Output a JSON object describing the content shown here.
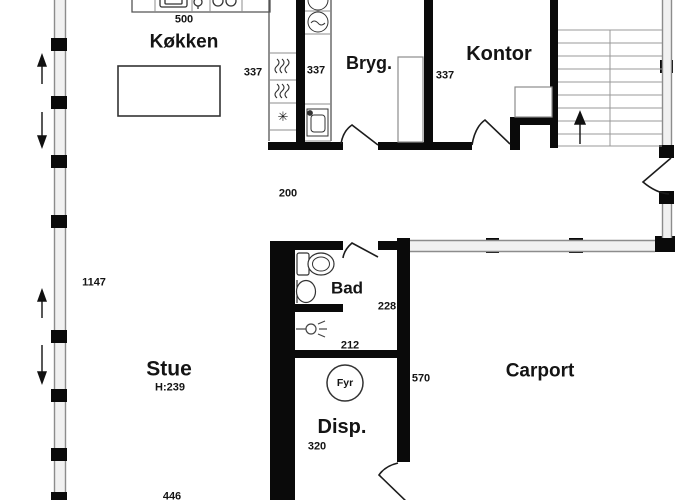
{
  "rooms": {
    "kokken": {
      "label": "Køkken"
    },
    "bryg": {
      "label": "Bryg."
    },
    "kontor": {
      "label": "Kontor"
    },
    "bad": {
      "label": "Bad"
    },
    "stue": {
      "label": "Stue",
      "ceiling_height": "H:239"
    },
    "disp": {
      "label": "Disp."
    },
    "carport": {
      "label": "Carport"
    }
  },
  "dimensions": {
    "kitchen_counter": "500",
    "kitchen_depth": "337",
    "bryg_depth": "337",
    "kontor_depth": "337",
    "hall_width": "200",
    "stue_side": "1147",
    "bad_width": "228",
    "shower_width": "212",
    "disp_side": "570",
    "disp_width": "320",
    "stue_bottom": "446"
  },
  "equipment": {
    "boiler": "Fyr"
  },
  "icons": {
    "snowflake": "✳"
  },
  "colors": {
    "wall": "#0a0a0a",
    "thin_line": "#8c8c8c",
    "text": "#141414"
  }
}
